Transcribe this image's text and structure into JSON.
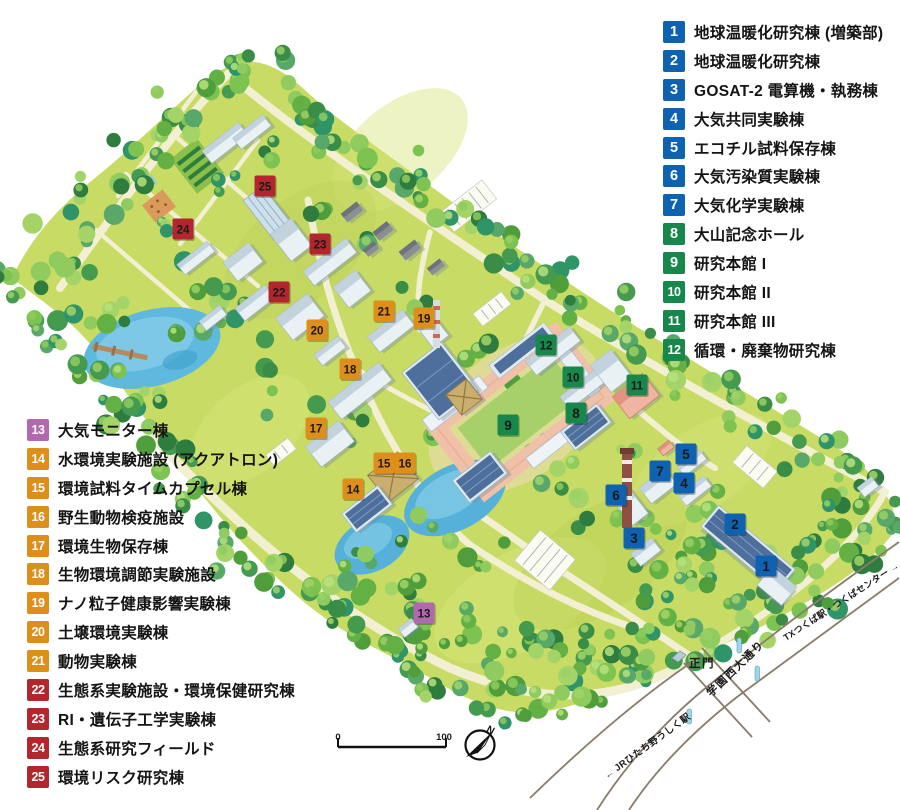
{
  "badge_colors": {
    "blue": "#0e62af",
    "green": "#18874b",
    "purple": "#b168ae",
    "orange": "#dd8e1b",
    "red": "#b2262e"
  },
  "legend": {
    "right": [
      {
        "num": "1",
        "label": "地球温暖化研究棟 (増築部)",
        "color": "blue"
      },
      {
        "num": "2",
        "label": "地球温暖化研究棟",
        "color": "blue"
      },
      {
        "num": "3",
        "label": "GOSAT-2 電算機・執務棟",
        "color": "blue"
      },
      {
        "num": "4",
        "label": "大気共同実験棟",
        "color": "blue"
      },
      {
        "num": "5",
        "label": "エコチル試料保存棟",
        "color": "blue"
      },
      {
        "num": "6",
        "label": "大気汚染質実験棟",
        "color": "blue"
      },
      {
        "num": "7",
        "label": "大気化学実験棟",
        "color": "blue"
      },
      {
        "num": "8",
        "label": "大山記念ホール",
        "color": "green"
      },
      {
        "num": "9",
        "label": "研究本館 I",
        "color": "green"
      },
      {
        "num": "10",
        "label": "研究本館 II",
        "color": "green"
      },
      {
        "num": "11",
        "label": "研究本館 III",
        "color": "green"
      },
      {
        "num": "12",
        "label": "循環・廃棄物研究棟",
        "color": "green"
      }
    ],
    "left": [
      {
        "num": "13",
        "label": "大気モニター棟",
        "color": "purple"
      },
      {
        "num": "14",
        "label": "水環境実験施設 (アクアトロン)",
        "color": "orange"
      },
      {
        "num": "15",
        "label": "環境試料タイムカプセル棟",
        "color": "orange"
      },
      {
        "num": "16",
        "label": "野生動物検疫施設",
        "color": "orange"
      },
      {
        "num": "17",
        "label": "環境生物保存棟",
        "color": "orange"
      },
      {
        "num": "18",
        "label": "生物環境調節実験施設",
        "color": "orange"
      },
      {
        "num": "19",
        "label": "ナノ粒子健康影響実験棟",
        "color": "orange"
      },
      {
        "num": "20",
        "label": "土壌環境実験棟",
        "color": "orange"
      },
      {
        "num": "21",
        "label": "動物実験棟",
        "color": "orange"
      },
      {
        "num": "22",
        "label": "生態系実験施設・環境保健研究棟",
        "color": "red"
      },
      {
        "num": "23",
        "label": "RI・遺伝子工学実験棟",
        "color": "red"
      },
      {
        "num": "24",
        "label": "生態系研究フィールド",
        "color": "red"
      },
      {
        "num": "25",
        "label": "環境リスク研究棟",
        "color": "red"
      }
    ]
  },
  "map": {
    "markers": [
      {
        "num": "1",
        "x": 766,
        "y": 566,
        "color": "blue"
      },
      {
        "num": "2",
        "x": 735,
        "y": 524,
        "color": "blue"
      },
      {
        "num": "3",
        "x": 634,
        "y": 538,
        "color": "blue"
      },
      {
        "num": "4",
        "x": 684,
        "y": 483,
        "color": "blue"
      },
      {
        "num": "5",
        "x": 686,
        "y": 454,
        "color": "blue"
      },
      {
        "num": "6",
        "x": 616,
        "y": 495,
        "color": "blue"
      },
      {
        "num": "7",
        "x": 660,
        "y": 471,
        "color": "blue"
      },
      {
        "num": "8",
        "x": 576,
        "y": 413,
        "color": "green"
      },
      {
        "num": "9",
        "x": 508,
        "y": 425,
        "color": "green"
      },
      {
        "num": "10",
        "x": 573,
        "y": 377,
        "color": "green"
      },
      {
        "num": "11",
        "x": 637,
        "y": 385,
        "color": "green"
      },
      {
        "num": "12",
        "x": 546,
        "y": 345,
        "color": "green"
      },
      {
        "num": "13",
        "x": 424,
        "y": 613,
        "color": "purple"
      },
      {
        "num": "14",
        "x": 353,
        "y": 489,
        "color": "orange"
      },
      {
        "num": "15",
        "x": 384,
        "y": 463,
        "color": "orange"
      },
      {
        "num": "16",
        "x": 405,
        "y": 463,
        "color": "orange"
      },
      {
        "num": "17",
        "x": 316,
        "y": 428,
        "color": "orange"
      },
      {
        "num": "18",
        "x": 350,
        "y": 369,
        "color": "orange"
      },
      {
        "num": "19",
        "x": 424,
        "y": 318,
        "color": "orange"
      },
      {
        "num": "20",
        "x": 317,
        "y": 330,
        "color": "orange"
      },
      {
        "num": "21",
        "x": 384,
        "y": 311,
        "color": "orange"
      },
      {
        "num": "22",
        "x": 279,
        "y": 292,
        "color": "red"
      },
      {
        "num": "23",
        "x": 320,
        "y": 244,
        "color": "red"
      },
      {
        "num": "24",
        "x": 183,
        "y": 229,
        "color": "red"
      },
      {
        "num": "25",
        "x": 265,
        "y": 186,
        "color": "red"
      }
    ],
    "gate_label": "正門",
    "road_labels": {
      "main": "学園西大通り",
      "jr": "← JRひたち野うしく駅",
      "tx": "TXつくば駅・つくばセンター →"
    },
    "scale_bar": {
      "start": "0",
      "end": "100"
    },
    "compass_label": "N"
  }
}
